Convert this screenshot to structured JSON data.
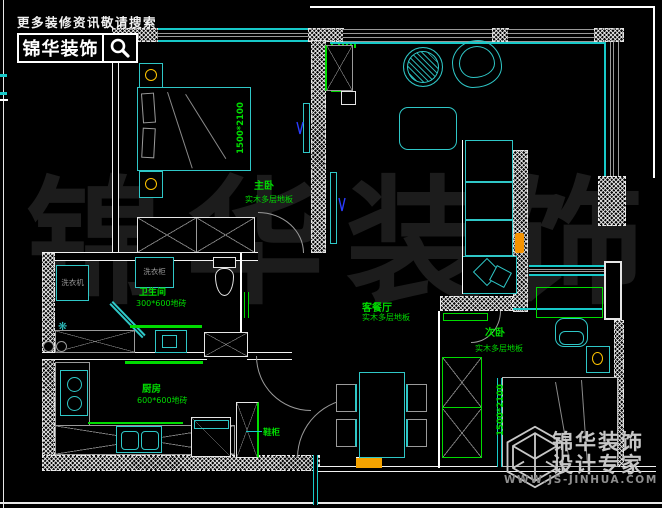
{
  "header": {
    "slogan": "更多装修资讯敬请搜索",
    "brand": "锦华装饰"
  },
  "watermark": "锦华装饰",
  "rooms": {
    "master": {
      "label": "主卧",
      "floor": "实木多层地板",
      "bed_dim": "1500*2100"
    },
    "living": {
      "label": "客餐厅",
      "floor": "实木多层地板"
    },
    "second": {
      "label": "次卧",
      "floor": "实木多层地板",
      "bed_dim": "1500*2100"
    },
    "bath": {
      "label": "卫生间",
      "tile": "300*600地砖"
    },
    "kitchen": {
      "label": "厨房",
      "tile": "600*600地砖"
    }
  },
  "fixtures": {
    "washing_machine": "洗衣机",
    "laundry_cabinet": "洗衣柜",
    "shoe_cabinet": "鞋柜"
  },
  "footer": {
    "brand": "锦华装饰",
    "tagline": "设计专家",
    "website": "WWW.JS-JINHUA.COM"
  },
  "colors": {
    "furniture_cyan": "#2fc7c7",
    "annotation_green": "#00dc00",
    "lamp_yellow": "#ffc400",
    "threshold_orange": "#f5a300",
    "wall_white": "#ffffff"
  }
}
